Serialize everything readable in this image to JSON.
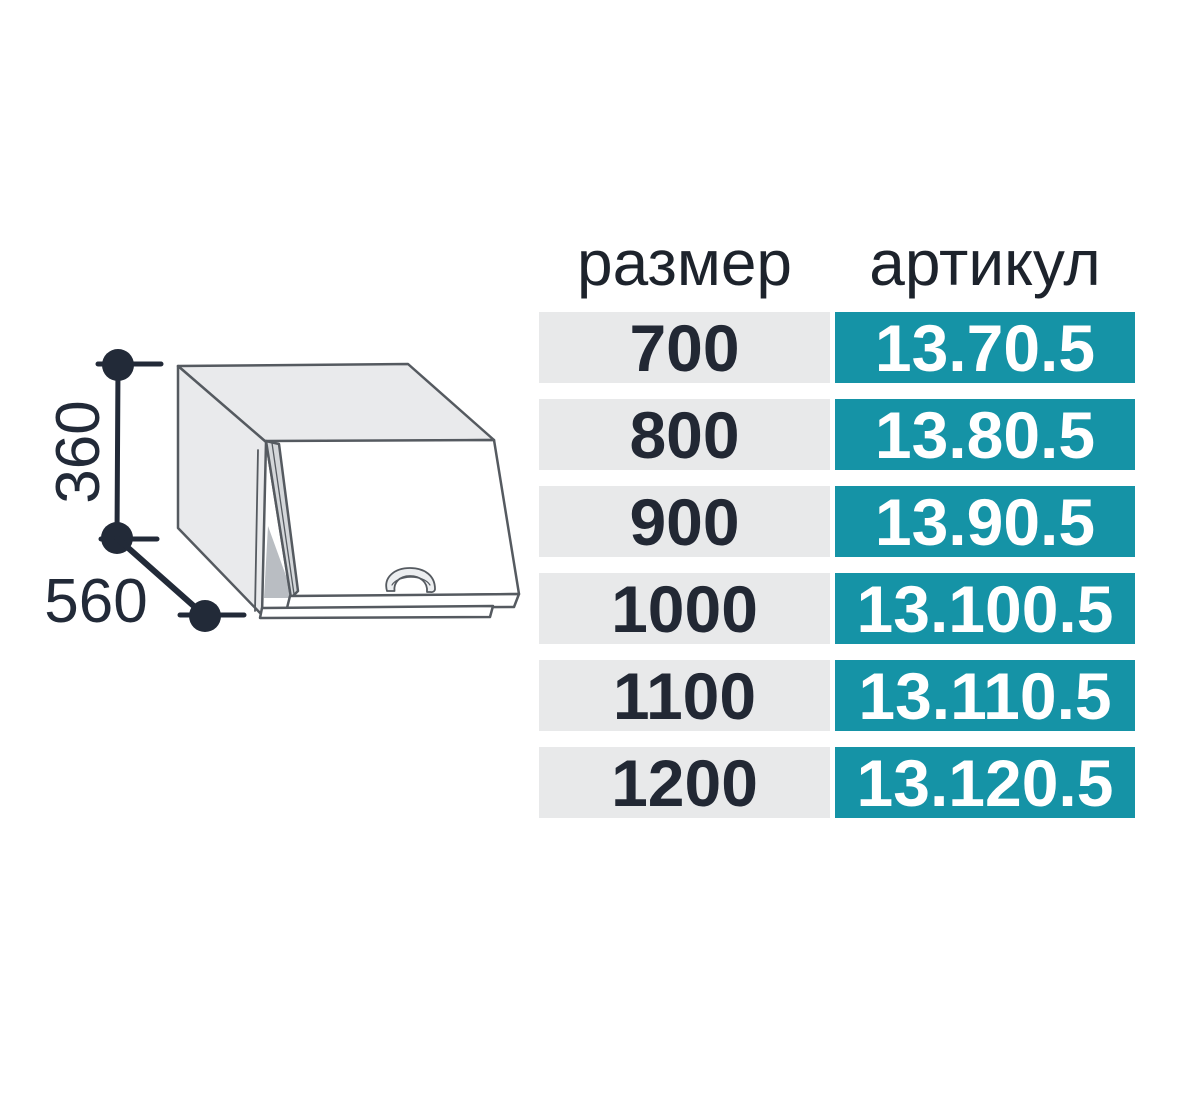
{
  "diagram": {
    "height_label": "360",
    "depth_label": "560",
    "line_color": "#222a38",
    "face_color": "#e9eaec",
    "outline_color": "#555a60"
  },
  "table": {
    "headers": [
      {
        "label": "размер"
      },
      {
        "label": "артикул"
      }
    ],
    "rows": [
      {
        "size": "700",
        "article": "13.70.5"
      },
      {
        "size": "800",
        "article": "13.80.5"
      },
      {
        "size": "900",
        "article": "13.90.5"
      },
      {
        "size": "1000",
        "article": "13.100.5"
      },
      {
        "size": "1100",
        "article": "13.110.5"
      },
      {
        "size": "1200",
        "article": "13.120.5"
      }
    ],
    "colors": {
      "size_cell_bg": "#e8e9ea",
      "size_cell_text": "#222834",
      "article_cell_bg": "#1593a6",
      "article_cell_text": "#ffffff"
    }
  }
}
